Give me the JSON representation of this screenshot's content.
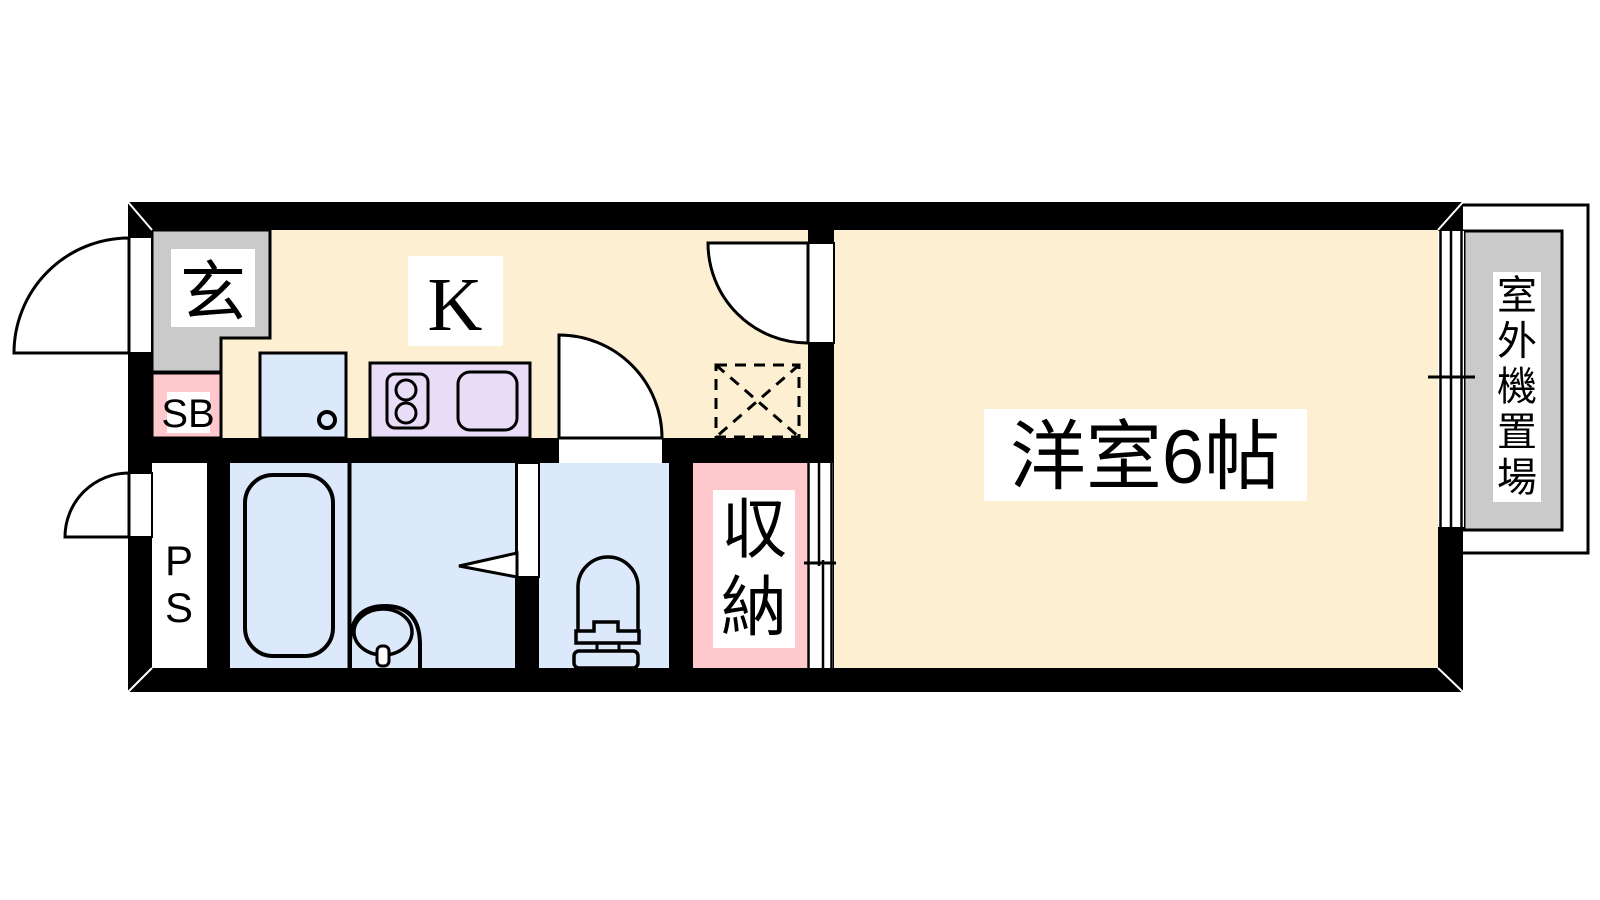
{
  "colors": {
    "wall": "#000000",
    "floor": "#FCEFD2",
    "entrance_gray": "#CACACA",
    "pink": "#FFC8CD",
    "water_blue": "#DBE9FA",
    "counter_lavender": "#E8DCF6",
    "label_bg": "#FFFFFF",
    "line": "#000000"
  },
  "labels": {
    "entrance": "玄",
    "shoe_box": "SB",
    "kitchen": "K",
    "pipe_space": "PS",
    "storage": "収納",
    "western_room": "洋室6帖",
    "outdoor_unit": "室外機置場"
  }
}
